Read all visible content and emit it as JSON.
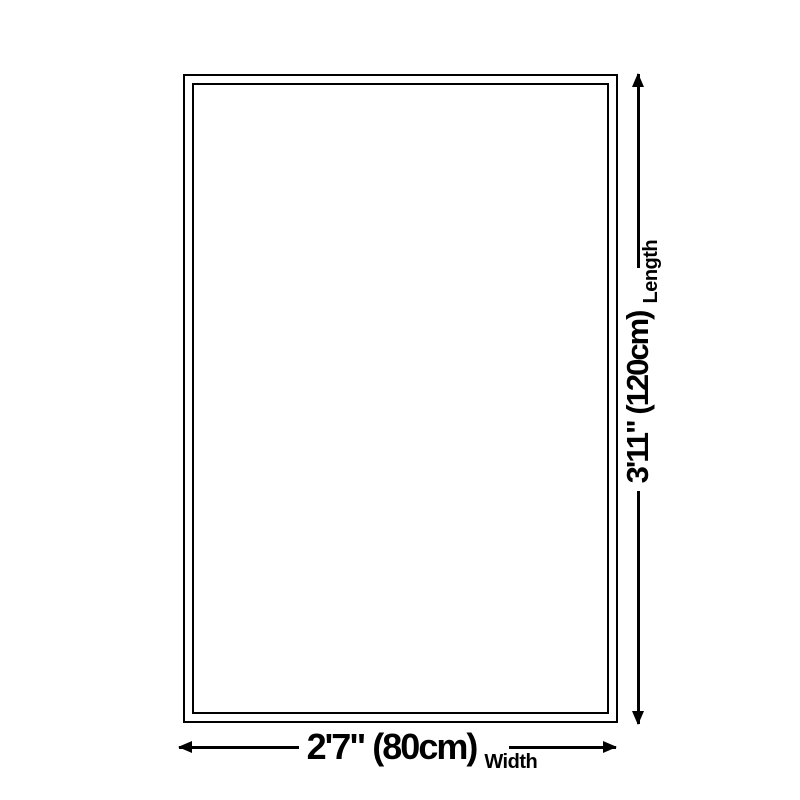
{
  "diagram": {
    "background_color": "#ffffff",
    "line_color": "#000000",
    "width_dimension": {
      "value": "2'7\" (80cm)",
      "label": "Width"
    },
    "length_dimension": {
      "value": "3'11\" (120cm)",
      "label": "Length"
    }
  }
}
